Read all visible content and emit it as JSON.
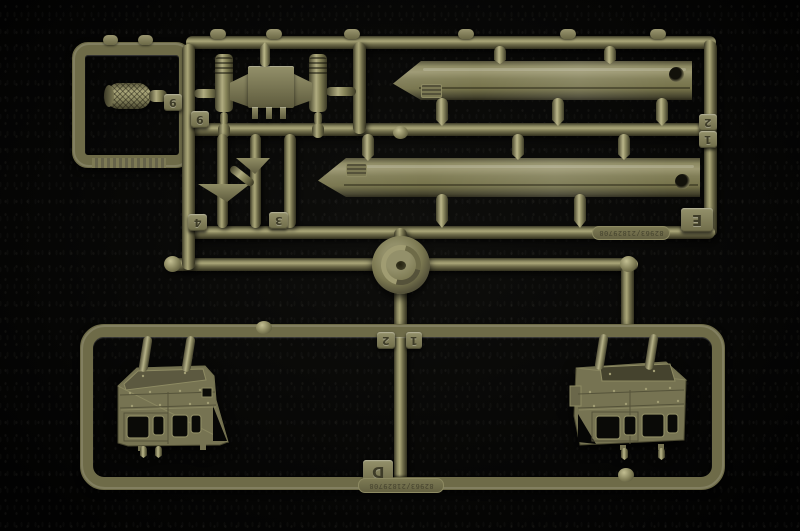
{
  "scene": {
    "description": "Photograph of an olive-drab injection-molded plastic model kit sprue (parts tree) on a black background; sprue is oriented upside-down so molded markings read rotated 180 degrees",
    "colors": {
      "plastic_base": "#6e6b48",
      "plastic_highlight": "#aaa678",
      "plastic_shadow": "#32301e",
      "background": "#060605"
    },
    "parts": {
      "muffler": "small cross-hatched muffler/grenade-shaped part",
      "bracket": "cross-member bracket with two ribbed shock-absorber cylinders",
      "rail_upper": "long chamfered I-beam rail with round hole at right end",
      "rail_lower": "long chamfered I-beam rail with round hole at right end",
      "masts": "two small funnel-topped mast parts",
      "reel": "round drum / coiled part at sprue center",
      "cab_left": "truck cab side panel with two window cutouts (left copy)",
      "cab_right": "truck cab side panel with two window cutouts (right copy)"
    }
  },
  "tags": {
    "muffler_a": "9",
    "muffler_b": "9",
    "mast_a": "4",
    "mast_b": "3",
    "right_upper": "2",
    "right_lower": "1",
    "center_left": "2",
    "center_right": "1",
    "letter_upper": "E",
    "letter_lower": "D"
  },
  "mold_marks": {
    "upper": "82963/21829708",
    "lower": "82963/21829708"
  }
}
